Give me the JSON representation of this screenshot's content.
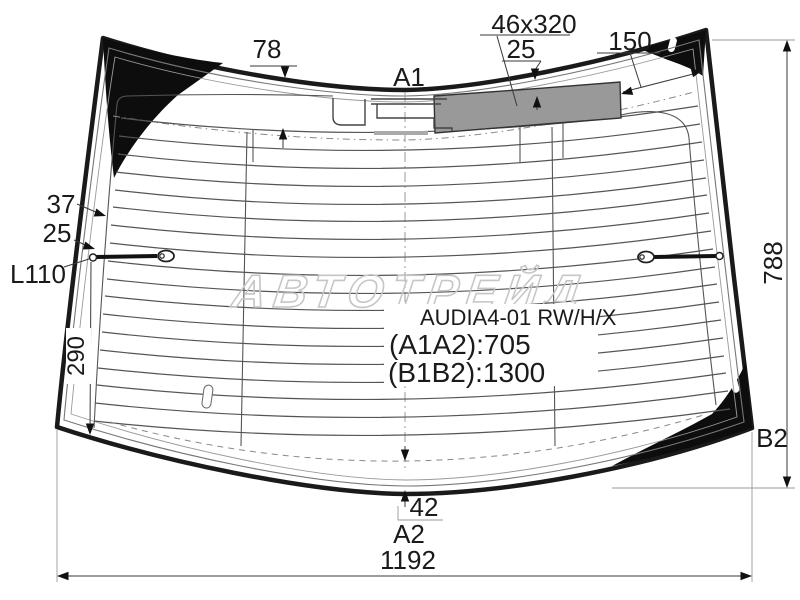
{
  "diagram": {
    "product": {
      "code": "AUDIA4-01 RW/H/X",
      "dim_a": "(A1A2):705",
      "dim_b": "(B1B2):1300"
    },
    "dimensions": {
      "top_edge_offset": "78",
      "stoplight_window": "46x320",
      "stoplight_offset": "25",
      "stoplight_right_gap": "150",
      "left_band_width": "37",
      "left_edge_offset": "25",
      "antenna_lead": "L110",
      "glass_height": "788",
      "lower_left_height": "290",
      "bottom_edge_offset": "42",
      "glass_width": "1192"
    },
    "points": {
      "a1": "A1",
      "a2": "A2",
      "b2": "B2"
    },
    "watermark": "АВТОТРЕЙД",
    "colors": {
      "outline": "#1a1a1a",
      "ceramic_band": "#0d0d0d",
      "stoplight_fill": "#999999",
      "heater_line": "#555555",
      "watermark": "#c6c6c6"
    }
  }
}
